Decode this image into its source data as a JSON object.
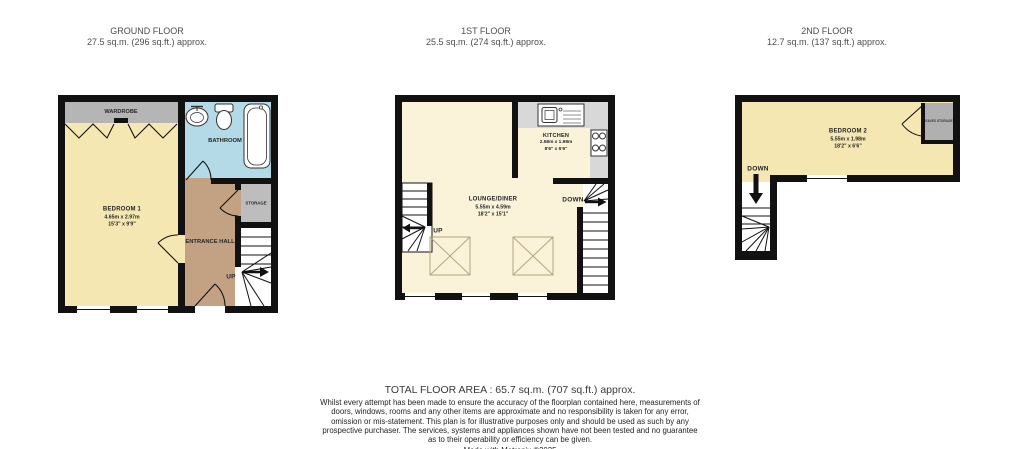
{
  "header": {
    "floors": [
      {
        "title": "GROUND FLOOR",
        "area": "27.5 sq.m. (296 sq.ft.) approx."
      },
      {
        "title": "1ST FLOOR",
        "area": "25.5 sq.m. (274 sq.ft.) approx."
      },
      {
        "title": "2ND FLOOR",
        "area": "12.7 sq.m. (137 sq.ft.) approx."
      }
    ]
  },
  "ground": {
    "bedroom1": {
      "name": "BEDROOM 1",
      "dims_m": "4.65m  x 2.97m",
      "dims_ft": "15'3\"  x 9'9\""
    },
    "wardrobe": "WARDROBE",
    "bathroom": "BATHROOM",
    "storage": "STORAGE",
    "hall": "ENTRANCE HALL",
    "up": "UP"
  },
  "first": {
    "lounge": {
      "name": "LOUNGE/DINER",
      "dims_m": "5.55m  x 4.59m",
      "dims_ft": "18'2\"  x 15'1\""
    },
    "kitchen": {
      "name": "KITCHEN",
      "dims_m": "2.58m  x 1.98m",
      "dims_ft": "8'6\"  x 6'6\""
    },
    "up": "UP",
    "down": "DOWN"
  },
  "second": {
    "bedroom2": {
      "name": "BEDROOM 2",
      "dims_m": "5.55m  x 1.98m",
      "dims_ft": "18'2\"  x 6'6\""
    },
    "eaves": "EAVES STORAGE",
    "down": "DOWN"
  },
  "footer": {
    "total": "TOTAL FLOOR AREA : 65.7 sq.m. (707 sq.ft.) approx.",
    "disclaimer": "Whilst every attempt has been made to ensure the accuracy of the floorplan contained here, measurements of doors, windows, rooms and any other items are approximate and no responsibility is taken for any error, omission or mis-statement. This plan is for illustrative purposes only and should be used as such by any prospective purchaser. The services, systems and appliances shown have not been tested and no guarantee as to their operability or efficiency can be given.",
    "credit": "Made with Metropix ©2025"
  },
  "colors": {
    "wall": "#111111",
    "bedroom_yellow": "#f5e7b2",
    "lounge_cream": "#faf3da",
    "bathroom_blue": "#b3dae6",
    "hall_tan": "#c3a284",
    "storage_gray": "#bdbdbd",
    "wardrobe_gray": "#b5b5b5",
    "counter_gray": "#d8d8d8",
    "closet_gray": "#b0b0b0",
    "stair_white": "#ffffff"
  }
}
